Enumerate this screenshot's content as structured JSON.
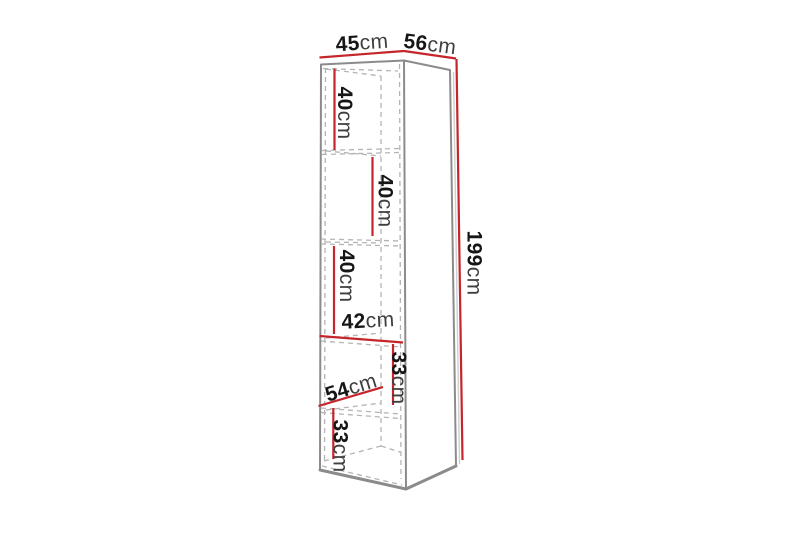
{
  "diagram": {
    "type": "furniture-dimension-diagram",
    "colors": {
      "background": "#ffffff",
      "outline_gray": "#8b8b8b",
      "edge_light": "#cfcfcf",
      "dashed_gray": "#b4b4b4",
      "dimension_red": "#c4262b",
      "number_text": "#161616",
      "unit_text": "#3f3f3f"
    },
    "labels": {
      "top_width": {
        "num": "45",
        "unit": "cm"
      },
      "top_depth": {
        "num": "56",
        "unit": "cm"
      },
      "total_height": {
        "num": "199",
        "unit": "cm"
      },
      "compartment1_height": {
        "num": "40",
        "unit": "cm"
      },
      "compartment2_height": {
        "num": "40",
        "unit": "cm"
      },
      "compartment3_height": {
        "num": "40",
        "unit": "cm"
      },
      "interior_width": {
        "num": "42",
        "unit": "cm"
      },
      "compartment4_height": {
        "num": "33",
        "unit": "cm"
      },
      "interior_depth": {
        "num": "54",
        "unit": "cm"
      },
      "compartment5_height": {
        "num": "33",
        "unit": "cm"
      }
    }
  }
}
